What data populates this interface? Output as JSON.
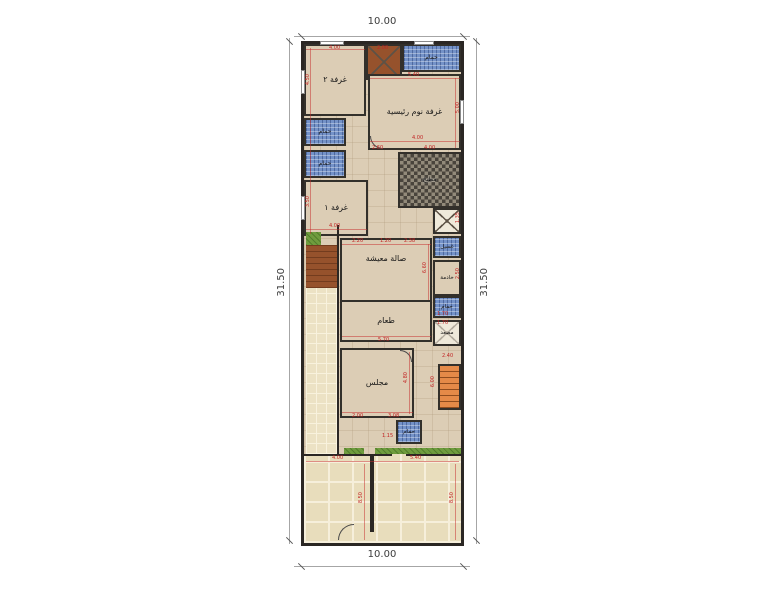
{
  "plan": {
    "overall": {
      "top": "10.00",
      "bottom": "10.00",
      "left": "31.50",
      "right": "31.50"
    },
    "rooms": {
      "room2": {
        "label": "غرفة ٢"
      },
      "master_bedroom": {
        "label": "غرفة نوم رئيسية"
      },
      "bath_top": {
        "label": "حمام"
      },
      "bath_left_upper": {
        "label": "حمام"
      },
      "bath_left_lower": {
        "label": "حمام"
      },
      "room1": {
        "label": "غرفة ١"
      },
      "kitchen": {
        "label": "مطبخ"
      },
      "living": {
        "label": "صالة معيشة"
      },
      "laundry": {
        "label": "غسيل"
      },
      "maid": {
        "label": "خادمة"
      },
      "bath_right": {
        "label": "حمام"
      },
      "elevator": {
        "label": "مصعد"
      },
      "dining": {
        "label": "طعام"
      },
      "majlis": {
        "label": "مجلس"
      },
      "bath_guest": {
        "label": "حمام"
      }
    },
    "dims": {
      "room2_w": "4.00",
      "room2_h": "4.50",
      "shaft_w": "2.00",
      "master_w": "5.40",
      "master_w2": "4.00",
      "master_h": "5.00",
      "hall_w": "2.60",
      "kitchen_w": "4.00",
      "room1_w": "4.00",
      "room1_h": "3.50",
      "shaft2_h": "1.35",
      "living_w1": "2.20",
      "living_w2": "1.20",
      "living_w3": "2.38",
      "living_h": "6.60",
      "maid_h": "2.50",
      "bath_right_w": "1.70",
      "elevator_w": "1.70",
      "dining_w": "5.70",
      "majlis_w1": "2.00",
      "majlis_w2": "3.08",
      "majlis_h": "4.80",
      "stairs_w": "2.40",
      "stairs_h": "6.00",
      "bath_guest_w": "1.15",
      "yard_left_w": "4.00",
      "yard_right_w": "5.40",
      "yard_left_h": "8.50",
      "yard_right_h": "8.50"
    },
    "colors": {
      "floor": "#dccdb5",
      "tile_blue": "#7492c8",
      "kitchen_dark": "#49443c",
      "stairs_orange": "#e58a48",
      "yard_stone": "#e8ddbc",
      "planter_green": "#6f9c3e",
      "wood_brown": "#96522c",
      "dim_red": "#c22424",
      "wall": "#2b2724"
    }
  }
}
